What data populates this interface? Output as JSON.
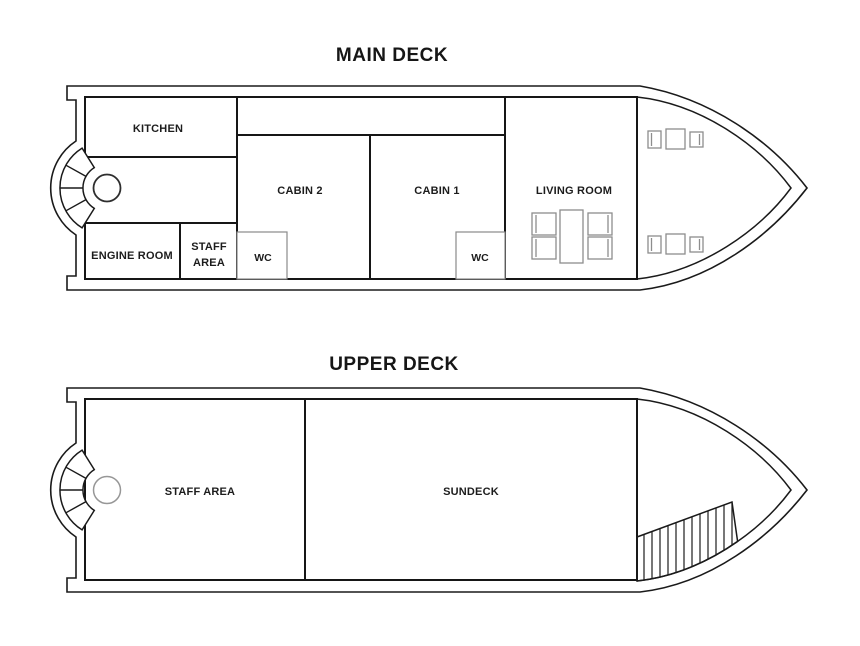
{
  "diagram": {
    "type": "boat-floor-plan",
    "colors": {
      "background": "#ffffff",
      "wall_line": "#161616",
      "hull_line": "#1a1a1a",
      "furniture_line": "#8d8d8d",
      "wc_border": "#8a8a8a",
      "hatch_line": "#2e2e2e",
      "upper_circle": "#979797",
      "main_circle": "#2e2e2e"
    }
  },
  "main_deck": {
    "title": "MAIN DECK",
    "rooms": {
      "kitchen": "KITCHEN",
      "engine_room": "ENGINE ROOM",
      "staff_line1": "STAFF",
      "staff_line2": "AREA",
      "cabin2": "CABIN 2",
      "cabin1": "CABIN 1",
      "wc_cabin2": "WC",
      "wc_cabin1": "WC",
      "living_room": "LIVING ROOM"
    }
  },
  "upper_deck": {
    "title": "UPPER DECK",
    "rooms": {
      "staff_area": "STAFF AREA",
      "sundeck": "SUNDECK"
    }
  }
}
